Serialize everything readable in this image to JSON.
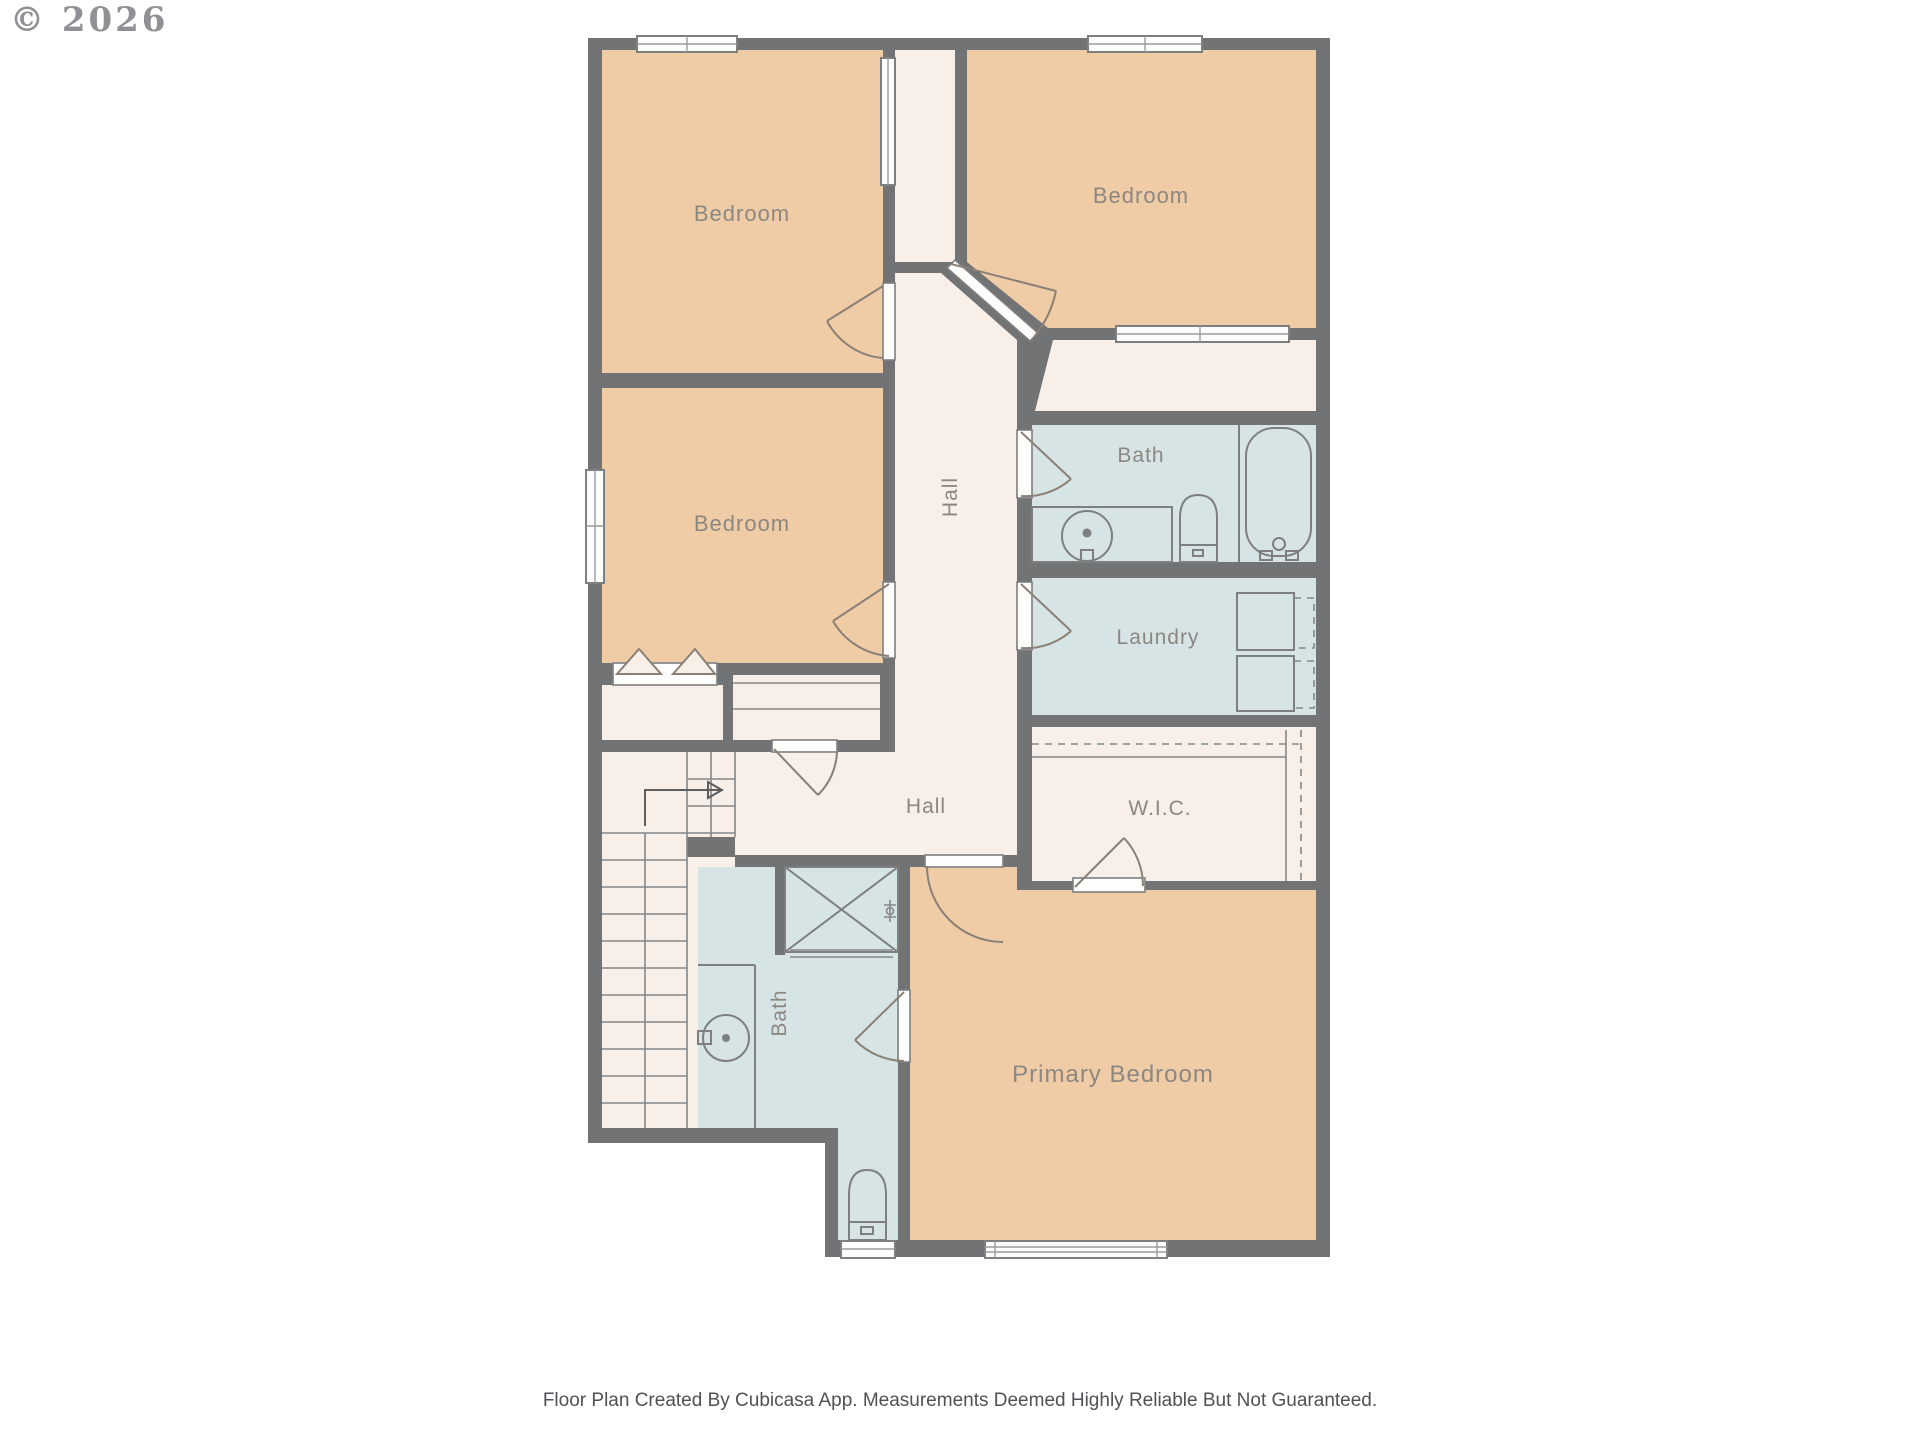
{
  "copyright": "© 2026",
  "footer": "Floor Plan Created By Cubicasa App. Measurements Deemed Highly Reliable But Not Guaranteed.",
  "rooms": {
    "bedroom_top_left": "Bedroom",
    "bedroom_top_right": "Bedroom",
    "bedroom_middle": "Bedroom",
    "hall_upper": "Hall",
    "hall_lower": "Hall",
    "bath_upper": "Bath",
    "laundry": "Laundry",
    "wic": "W.I.C.",
    "bath_lower": "Bath",
    "primary_bedroom": "Primary Bedroom"
  },
  "fixtures": {
    "bath_upper": [
      "sink-icon",
      "toilet-icon",
      "bathtub-icon"
    ],
    "bath_lower": [
      "shower-icon",
      "sink-icon",
      "toilet-icon"
    ],
    "laundry": [
      "washer-icon",
      "dryer-icon"
    ],
    "stairs": [
      "stair-treads",
      "stair-direction-arrow"
    ],
    "closets": [
      "bifold-door-icon",
      "linen-shelves",
      "wic-shelves"
    ]
  },
  "colors": {
    "wall": "#717375",
    "bedroom_floor": "#f0cca6",
    "hall_floor": "#f7efe8",
    "wet_floor": "#d7e4e6",
    "window": "#fdfdfc",
    "fixture_line": "#7d7f81",
    "label_text": "#8c8781",
    "footer_text": "#4e5256",
    "copyright_text": "#8f9194"
  }
}
